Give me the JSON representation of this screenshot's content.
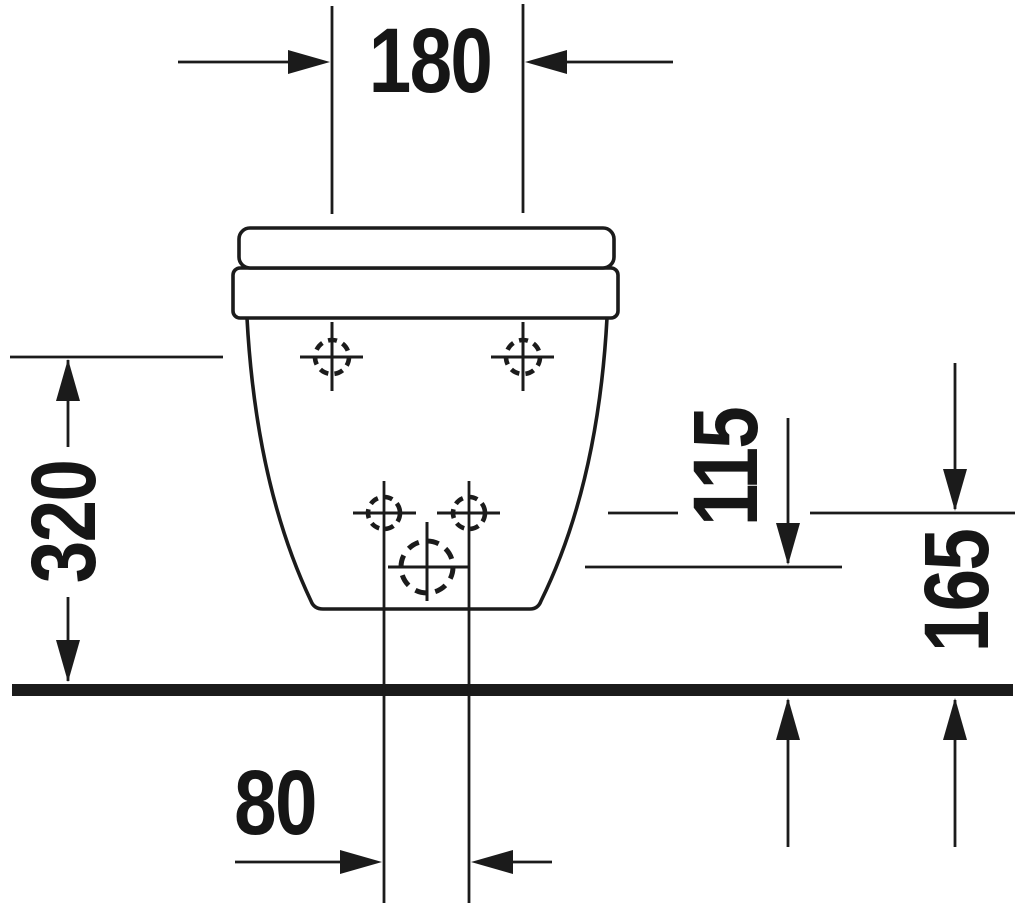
{
  "drawing": {
    "type": "technical-dimension-drawing",
    "subject": "wall-hung-sanitary-fixture-rear-view",
    "colors": {
      "ink": "#1b1b1b",
      "background": "#ffffff"
    },
    "dims": {
      "top_width": "180",
      "floor_to_upper_holes": "320",
      "floor_to_outlet": "115",
      "floor_to_lower_holes": "165",
      "lower_holes_spacing": "80"
    }
  }
}
